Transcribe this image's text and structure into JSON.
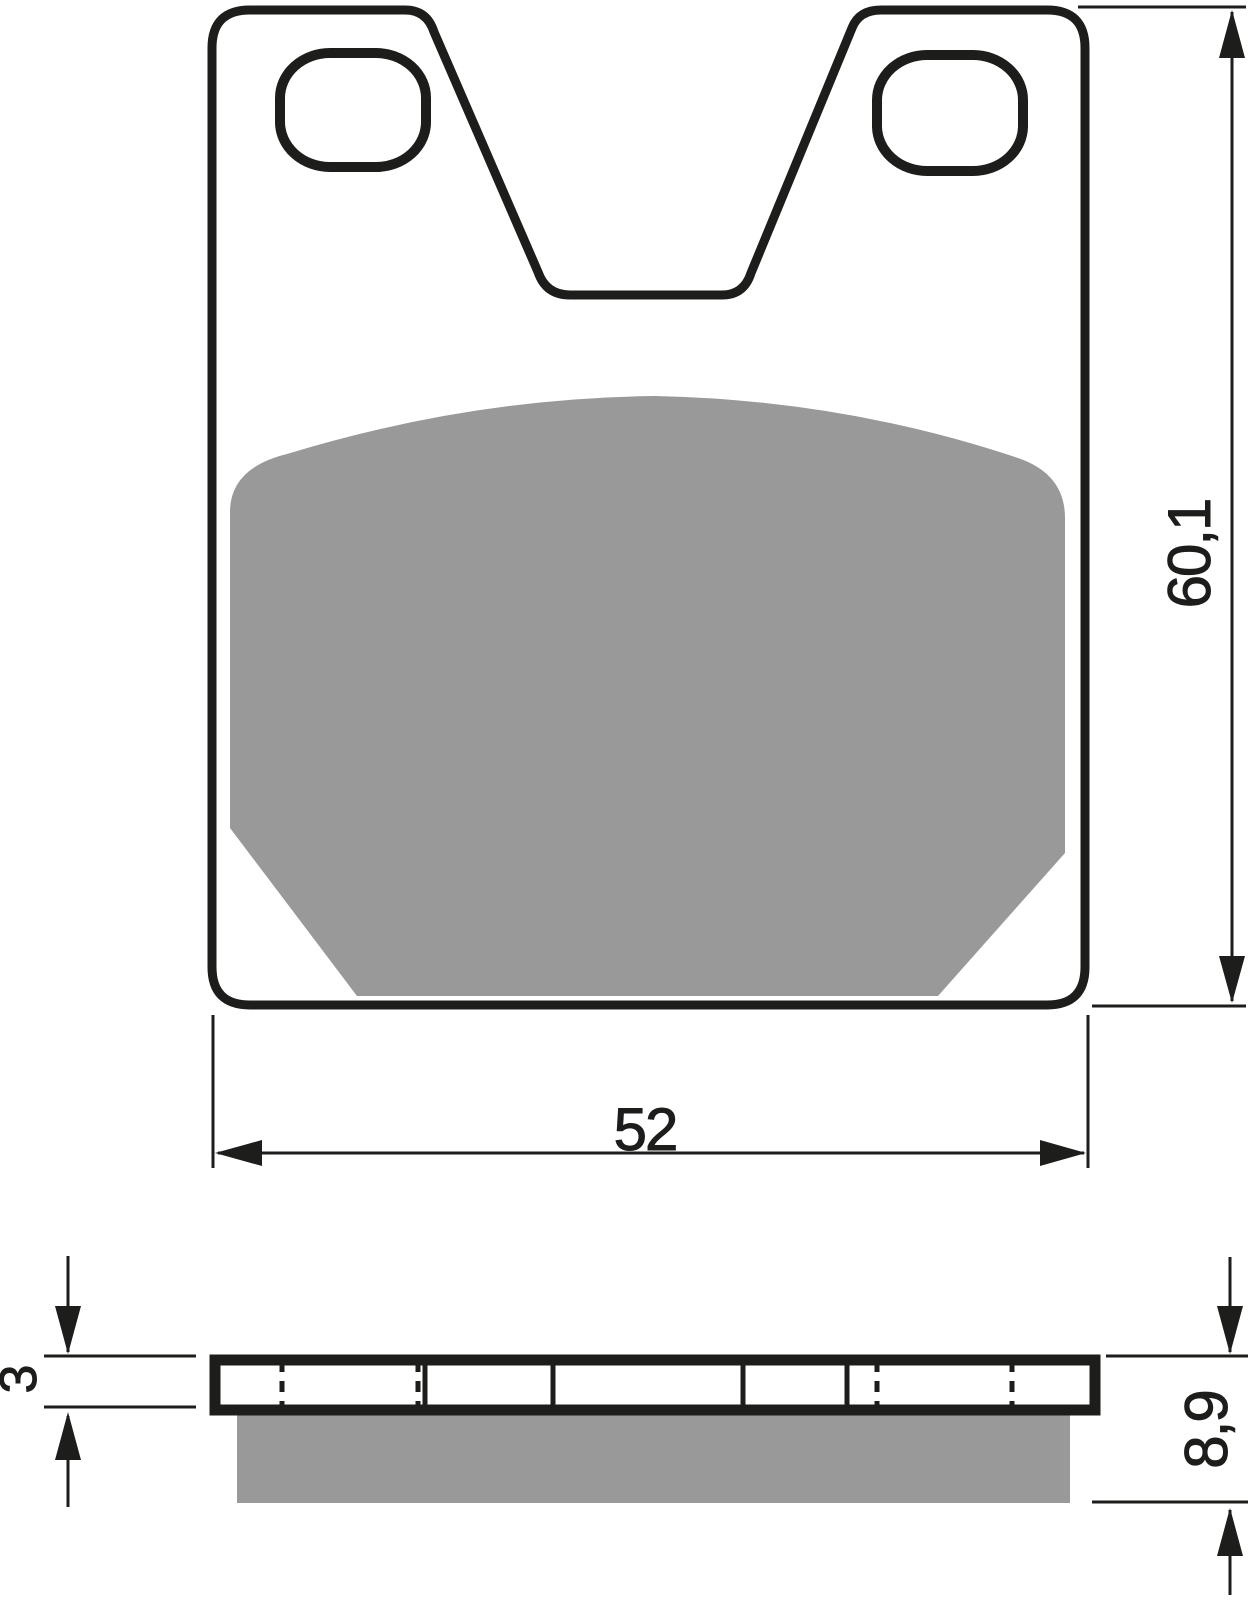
{
  "dimensions": {
    "height": {
      "label": "60,1"
    },
    "width": {
      "label": "52"
    },
    "plate_thickness": {
      "label": "3"
    },
    "total_thickness": {
      "label": "8,9"
    }
  },
  "colors": {
    "line": "#1d1d1b",
    "friction_material": "#999999",
    "metal_fill": "#ffffff",
    "background": "#ffffff"
  }
}
